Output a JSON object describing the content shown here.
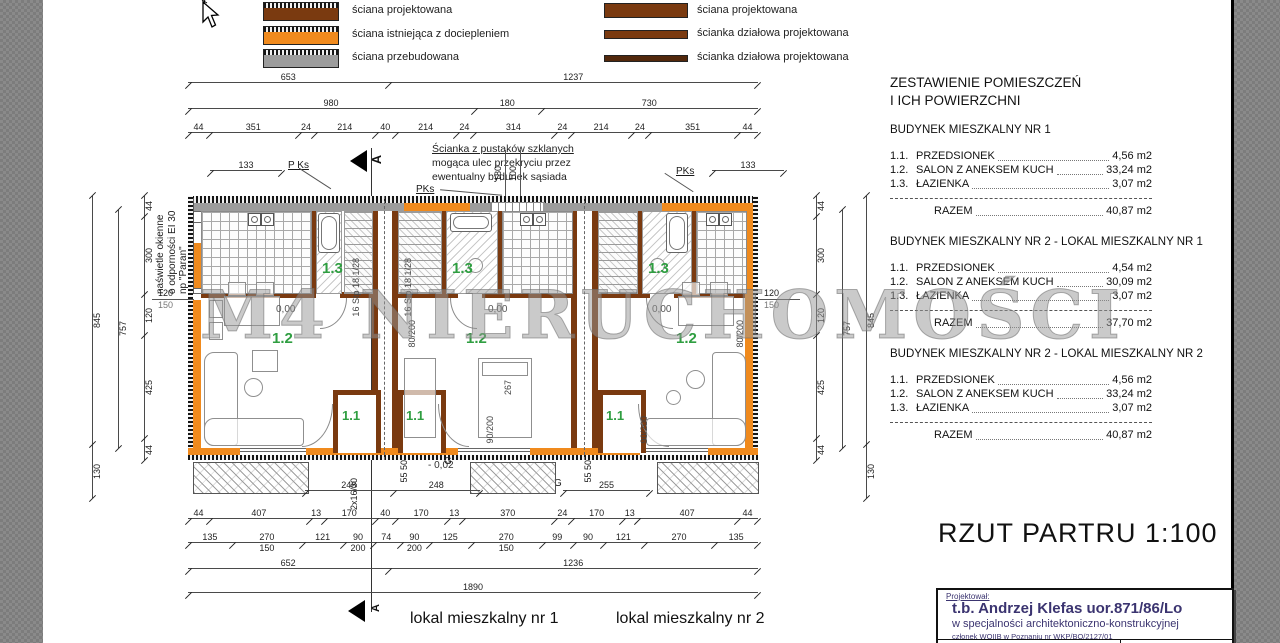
{
  "colors": {
    "orange": "#f08a1d",
    "brown": "#7a3a10",
    "graywall": "#9c9c9c",
    "green": "#2f9e41",
    "navy": "#3b3470"
  },
  "legend": {
    "col1": [
      {
        "label": "ściana projektowana"
      },
      {
        "label": "ściana istniejąca z dociepleniem"
      },
      {
        "label": "ściana przebudowana"
      }
    ],
    "col2": [
      {
        "label": "ściana projektowana"
      },
      {
        "label": "ścianka działowa projektowana"
      },
      {
        "label": "ścianka działowa projektowana"
      }
    ]
  },
  "summary": {
    "title1": "ZESTAWIENIE POMIESZCZEŃ",
    "title2": "I ICH POWIERZCHNI",
    "total_label": "RAZEM",
    "sections": [
      {
        "heading": "BUDYNEK MIESZKALNY NR 1",
        "rows": [
          {
            "no": "1.1.",
            "name": "PRZEDSIONEK",
            "area": "4,56 m2"
          },
          {
            "no": "1.2.",
            "name": "SALON Z ANEKSEM KUCH",
            "area": "33,24 m2"
          },
          {
            "no": "1.3.",
            "name": "ŁAZIENKA",
            "area": "3,07 m2"
          }
        ],
        "total": "40,87 m2"
      },
      {
        "heading": "BUDYNEK MIESZKALNY NR 2 - LOKAL MIESZKALNY NR 1",
        "rows": [
          {
            "no": "1.1.",
            "name": "PRZEDSIONEK",
            "area": "4,54 m2"
          },
          {
            "no": "1.2.",
            "name": "SALON Z ANEKSEM KUCH",
            "area": "30,09 m2"
          },
          {
            "no": "1.3.",
            "name": "ŁAZIENKA",
            "area": "3,07 m2"
          }
        ],
        "total": "37,70 m2"
      },
      {
        "heading": "BUDYNEK MIESZKALNY NR 2 - LOKAL MIESZKALNY NR 2",
        "rows": [
          {
            "no": "1.1.",
            "name": "PRZEDSIONEK",
            "area": "4,56 m2"
          },
          {
            "no": "1.2.",
            "name": "SALON Z ANEKSEM KUCH",
            "area": "33,24 m2"
          },
          {
            "no": "1.3.",
            "name": "ŁAZIENKA",
            "area": "3,07 m2"
          }
        ],
        "total": "40,87 m2"
      }
    ]
  },
  "drawing_title": "RZUT PARTRU 1:100",
  "titleblock": {
    "role": "Projektował:",
    "name": "t.b. Andrzej Klefas uor.871/86/Lo",
    "spec": "w specjalności architektoniczno-konstrukcyjnej",
    "member": "członek WOIIB w Poznaniu nr WKP/BO/2127/01"
  },
  "footer": {
    "lokal1": "lokal mieszkalny nr 1",
    "lokal2": "lokal mieszkalny nr 2"
  },
  "watermark": "M4 NIERUCHOMOŚCI",
  "plan": {
    "section_letter": "A",
    "labels": {
      "r11": "1.1",
      "r12": "1.2",
      "r13": "1.3",
      "level_zero": "0,00",
      "level_minus": "- 0,02",
      "g": "G",
      "pks": "PKs",
      "pks_spaced": "P Ks",
      "stairs": "16 Stp 18 1/28",
      "door80": "80/200",
      "door90": "90/200"
    },
    "note": {
      "line1": "Ścianka z pustaków szklanych",
      "line2": "mogąca ulec przekryciu przez",
      "line3": "ewentualny bydunek sąsiada"
    },
    "naswietle": {
      "line1": "naświetle okienne",
      "line2": "o odporności EI 30",
      "line3": "np \"Paran\""
    }
  },
  "dims": {
    "top1": [
      "653",
      "1237"
    ],
    "top2": [
      "980",
      "180",
      "730"
    ],
    "top3": [
      "44",
      "351",
      "24",
      "214",
      "40",
      "214",
      "24",
      "314",
      "24",
      "214",
      "24",
      "351",
      "44"
    ],
    "mid_a": [
      "248",
      "248"
    ],
    "mid_b": [
      "255"
    ],
    "bottom1": [
      "44",
      "407",
      "13",
      "170",
      "40",
      "170",
      "13",
      "370",
      "24",
      "170",
      "13",
      "407",
      "44"
    ],
    "bottom2": [
      {
        "v": "135"
      },
      {
        "v": "270",
        "sub": "150"
      },
      {
        "v": "121"
      },
      {
        "v": "90",
        "sub": "200"
      },
      {
        "v": "74"
      },
      {
        "v": "90",
        "sub": "200"
      },
      {
        "v": "125"
      },
      {
        "v": "270",
        "sub": "150"
      },
      {
        "v": "99"
      },
      {
        "v": "90"
      },
      {
        "v": "121"
      },
      {
        "v": "270"
      },
      {
        "v": "135"
      }
    ],
    "bottom3": [
      "652",
      "1236"
    ],
    "bottom4": [
      "1890"
    ],
    "left_outer": [
      "845",
      "130"
    ],
    "left_mid": [
      "757"
    ],
    "left_inner": [
      "44",
      "300",
      "120",
      "425",
      "44"
    ],
    "right_inner": [
      "44",
      "300",
      "120",
      "425",
      "44"
    ],
    "right_mid": [
      "757"
    ],
    "right_outer": [
      "845",
      "130"
    ],
    "d133": [
      "133"
    ],
    "d120": "120",
    "d150": "150",
    "d180": "180",
    "d100": "100",
    "d267": "267",
    "d5550": "55 50",
    "riser": "2x16/30"
  }
}
